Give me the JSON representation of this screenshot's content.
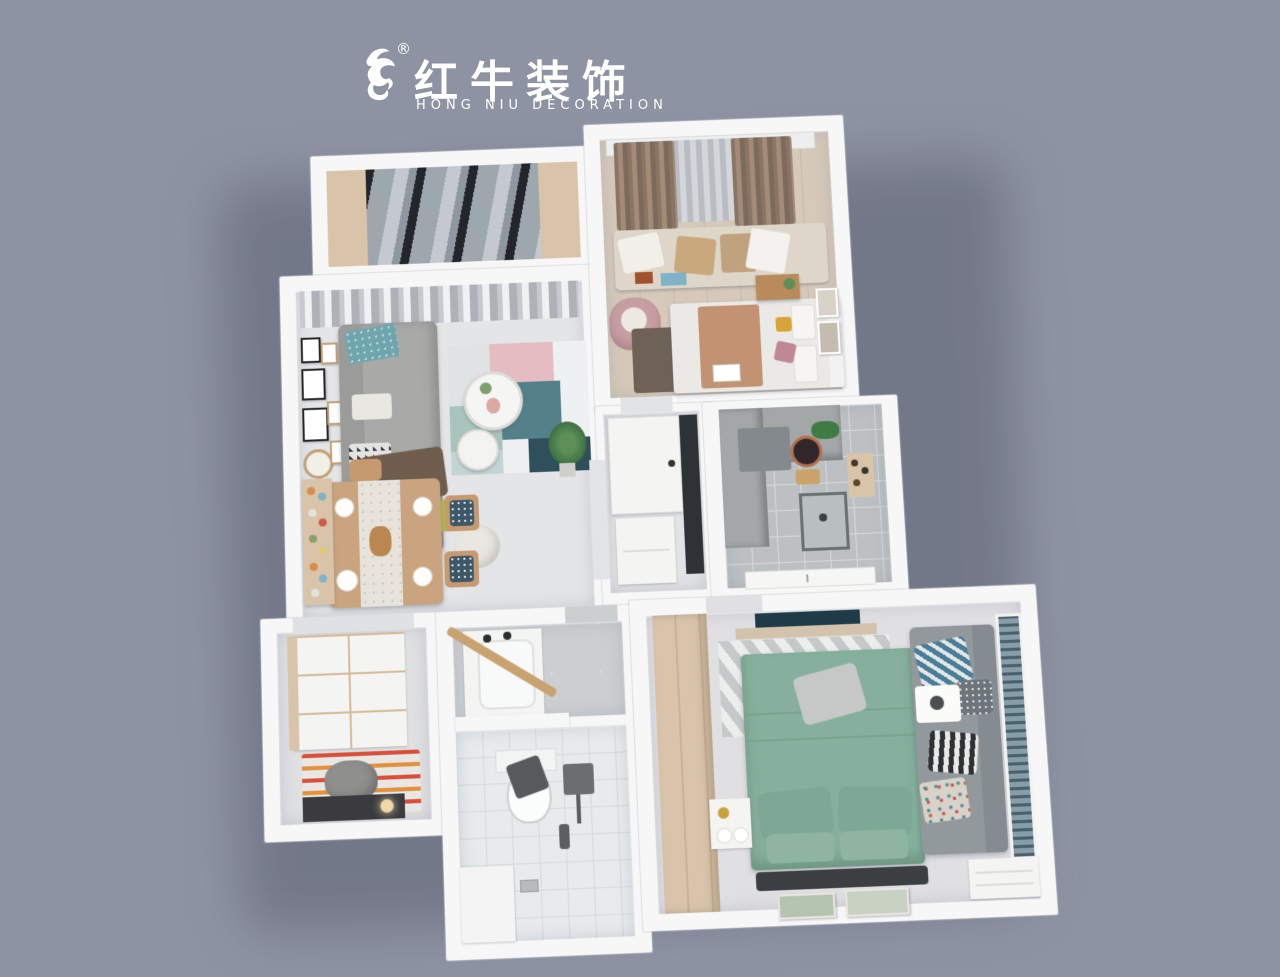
{
  "logo": {
    "zh": "红牛装饰",
    "registered": "®",
    "en": "HONG NIU DECORATION",
    "color": "#ffffff",
    "icon": "bull-brushstroke"
  },
  "background_color": "#8e93a3",
  "palette": {
    "wall_white": "#f7f7f8",
    "floor_tile": "#e3e4e6",
    "wood_light": "#d9c4a9",
    "sofa_gray": "#a9a9a7",
    "bed_green": "#86b09d",
    "pillow_green": "#7da895",
    "rug_teal": "#54808a",
    "rug_pink": "#e5bcc2",
    "rug_dark_teal": "#2f505a",
    "curtain_brown": "#97816f",
    "glass_dark": "#22262b",
    "blinds_teal": "#5f7a87",
    "accent_rug_orange": "#d8503a"
  },
  "rooms": [
    {
      "name": "balcony"
    },
    {
      "name": "living-room"
    },
    {
      "name": "dining-area"
    },
    {
      "name": "entry"
    },
    {
      "name": "guest-bedroom"
    },
    {
      "name": "hallway"
    },
    {
      "name": "kitchen"
    },
    {
      "name": "bathroom"
    },
    {
      "name": "master-bedroom"
    }
  ]
}
